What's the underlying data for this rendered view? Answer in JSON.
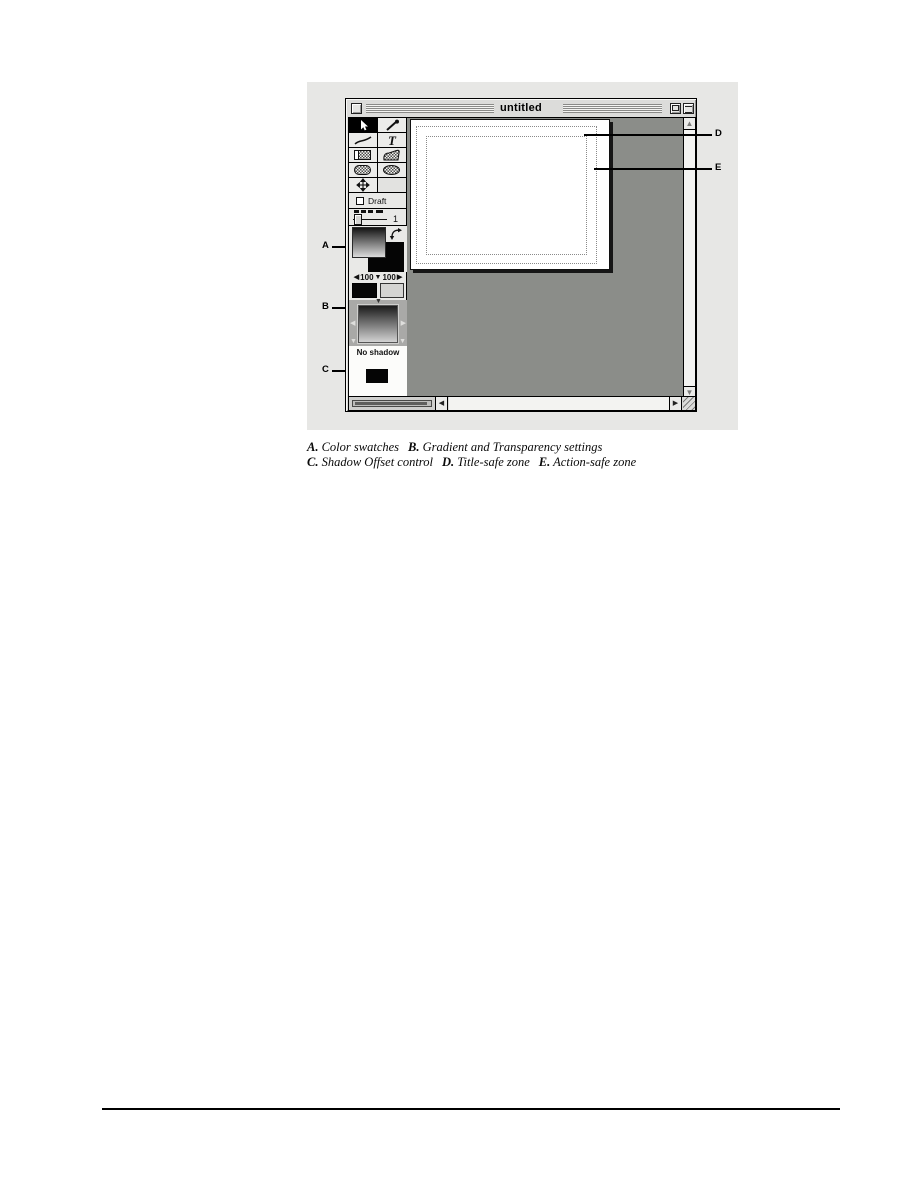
{
  "figure": {
    "window": {
      "title": "untitled",
      "titlebar": {
        "close_box": "close-box",
        "zoom_box": "zoom-box",
        "collapse_box": "collapse-box"
      },
      "palette": {
        "tools": [
          {
            "name": "selection-tool",
            "selected": true
          },
          {
            "name": "eyedropper-tool",
            "selected": false
          },
          {
            "name": "line-tool",
            "selected": false
          },
          {
            "name": "text-tool",
            "selected": false,
            "glyph": "T"
          },
          {
            "name": "rectangle-tool",
            "selected": false
          },
          {
            "name": "polygon-tool",
            "selected": false
          },
          {
            "name": "rounded-rectangle-tool",
            "selected": false
          },
          {
            "name": "oval-tool",
            "selected": false
          },
          {
            "name": "move-tool",
            "selected": false
          }
        ],
        "draft_label": "Draft",
        "line_weight_value": "1",
        "transparency_start": "100",
        "transparency_end": "100",
        "shadow_status": "No shadow"
      },
      "icons": {
        "swap_colors": "curved-double-arrow",
        "scroll_up": "▲",
        "scroll_down": "▼",
        "scroll_left": "◀",
        "scroll_right": "▶",
        "transp_left": "◀",
        "transp_down": "▼",
        "transp_right": "▶"
      }
    },
    "callouts": {
      "a": "A",
      "b": "B",
      "c": "C",
      "d": "D",
      "e": "E"
    }
  },
  "caption": {
    "items": [
      {
        "label": "A.",
        "text": "Color swatches"
      },
      {
        "label": "B.",
        "text": "Gradient and Transparency settings"
      },
      {
        "label": "C.",
        "text": "Shadow Offset control"
      },
      {
        "label": "D.",
        "text": "Title-safe zone"
      },
      {
        "label": "E.",
        "text": "Action-safe zone"
      }
    ]
  },
  "colors": {
    "figure_background": "#e7e7e5",
    "workspace_gray": "#8b8d89",
    "window_chrome": "#dcdcda",
    "canvas_white": "#ffffff"
  }
}
